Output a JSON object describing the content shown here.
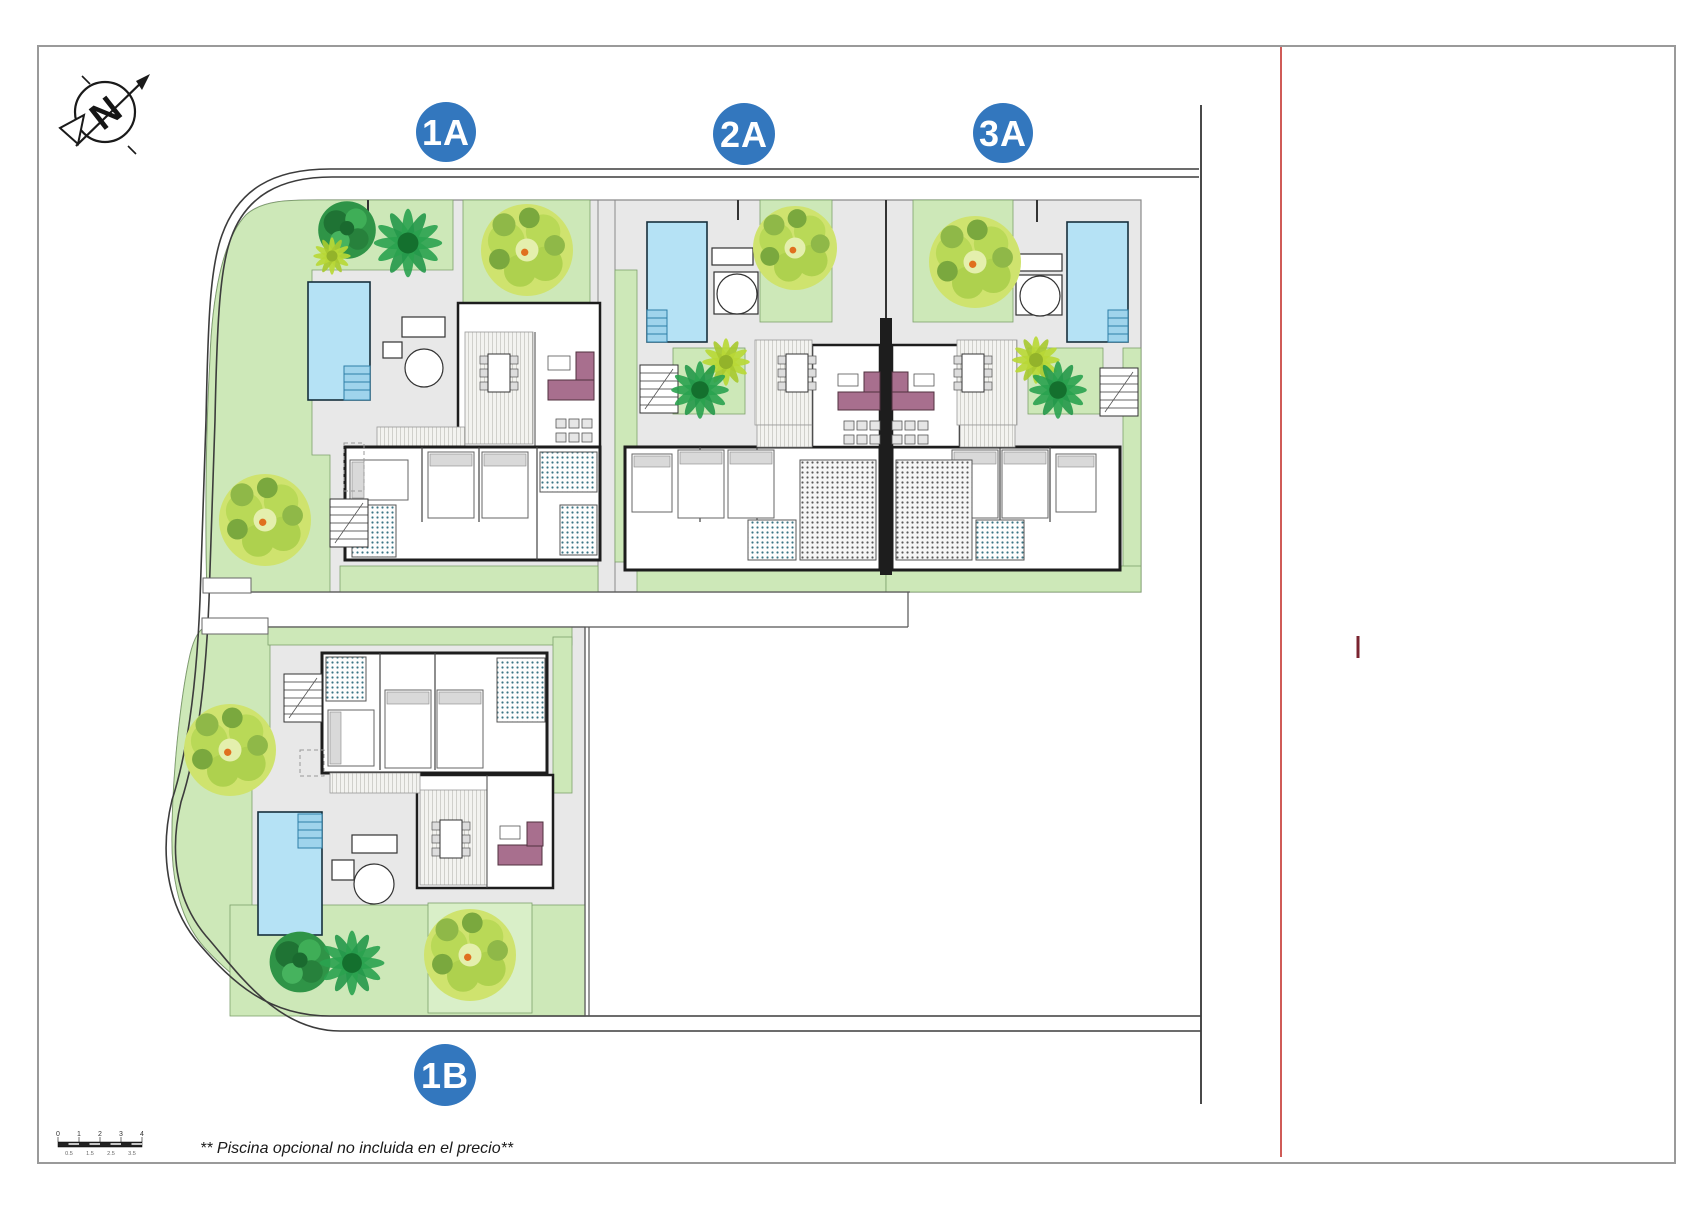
{
  "site_plan": {
    "villas": [
      {
        "id": "1A",
        "label": "1A",
        "pool": true
      },
      {
        "id": "2A",
        "label": "2A",
        "pool": true
      },
      {
        "id": "3A",
        "label": "3A",
        "pool": true
      },
      {
        "id": "1B",
        "label": "1B",
        "pool": true
      }
    ],
    "compass": {
      "letter": "N"
    },
    "footnote": "** Piscina opcional no incluida en el precio**",
    "scale_bar": {
      "top_labels": [
        "0",
        "1",
        "2",
        "3",
        "4"
      ],
      "bottom_labels": [
        "0.5",
        "1.5",
        "2.5",
        "3.5"
      ]
    },
    "colors": {
      "label_circle_blue": "#3377be",
      "garden_green": "#cde8b8",
      "garden_green_light": "#d9efc8",
      "paving_gray": "#e8e8e8",
      "pool_blue": "#b5e2f5",
      "wall_black": "#1d1d1d",
      "sofa_plum": "#a86f8e",
      "reference_line_red": "#c5322d",
      "bath_tile_teal": "#3a7585"
    }
  }
}
